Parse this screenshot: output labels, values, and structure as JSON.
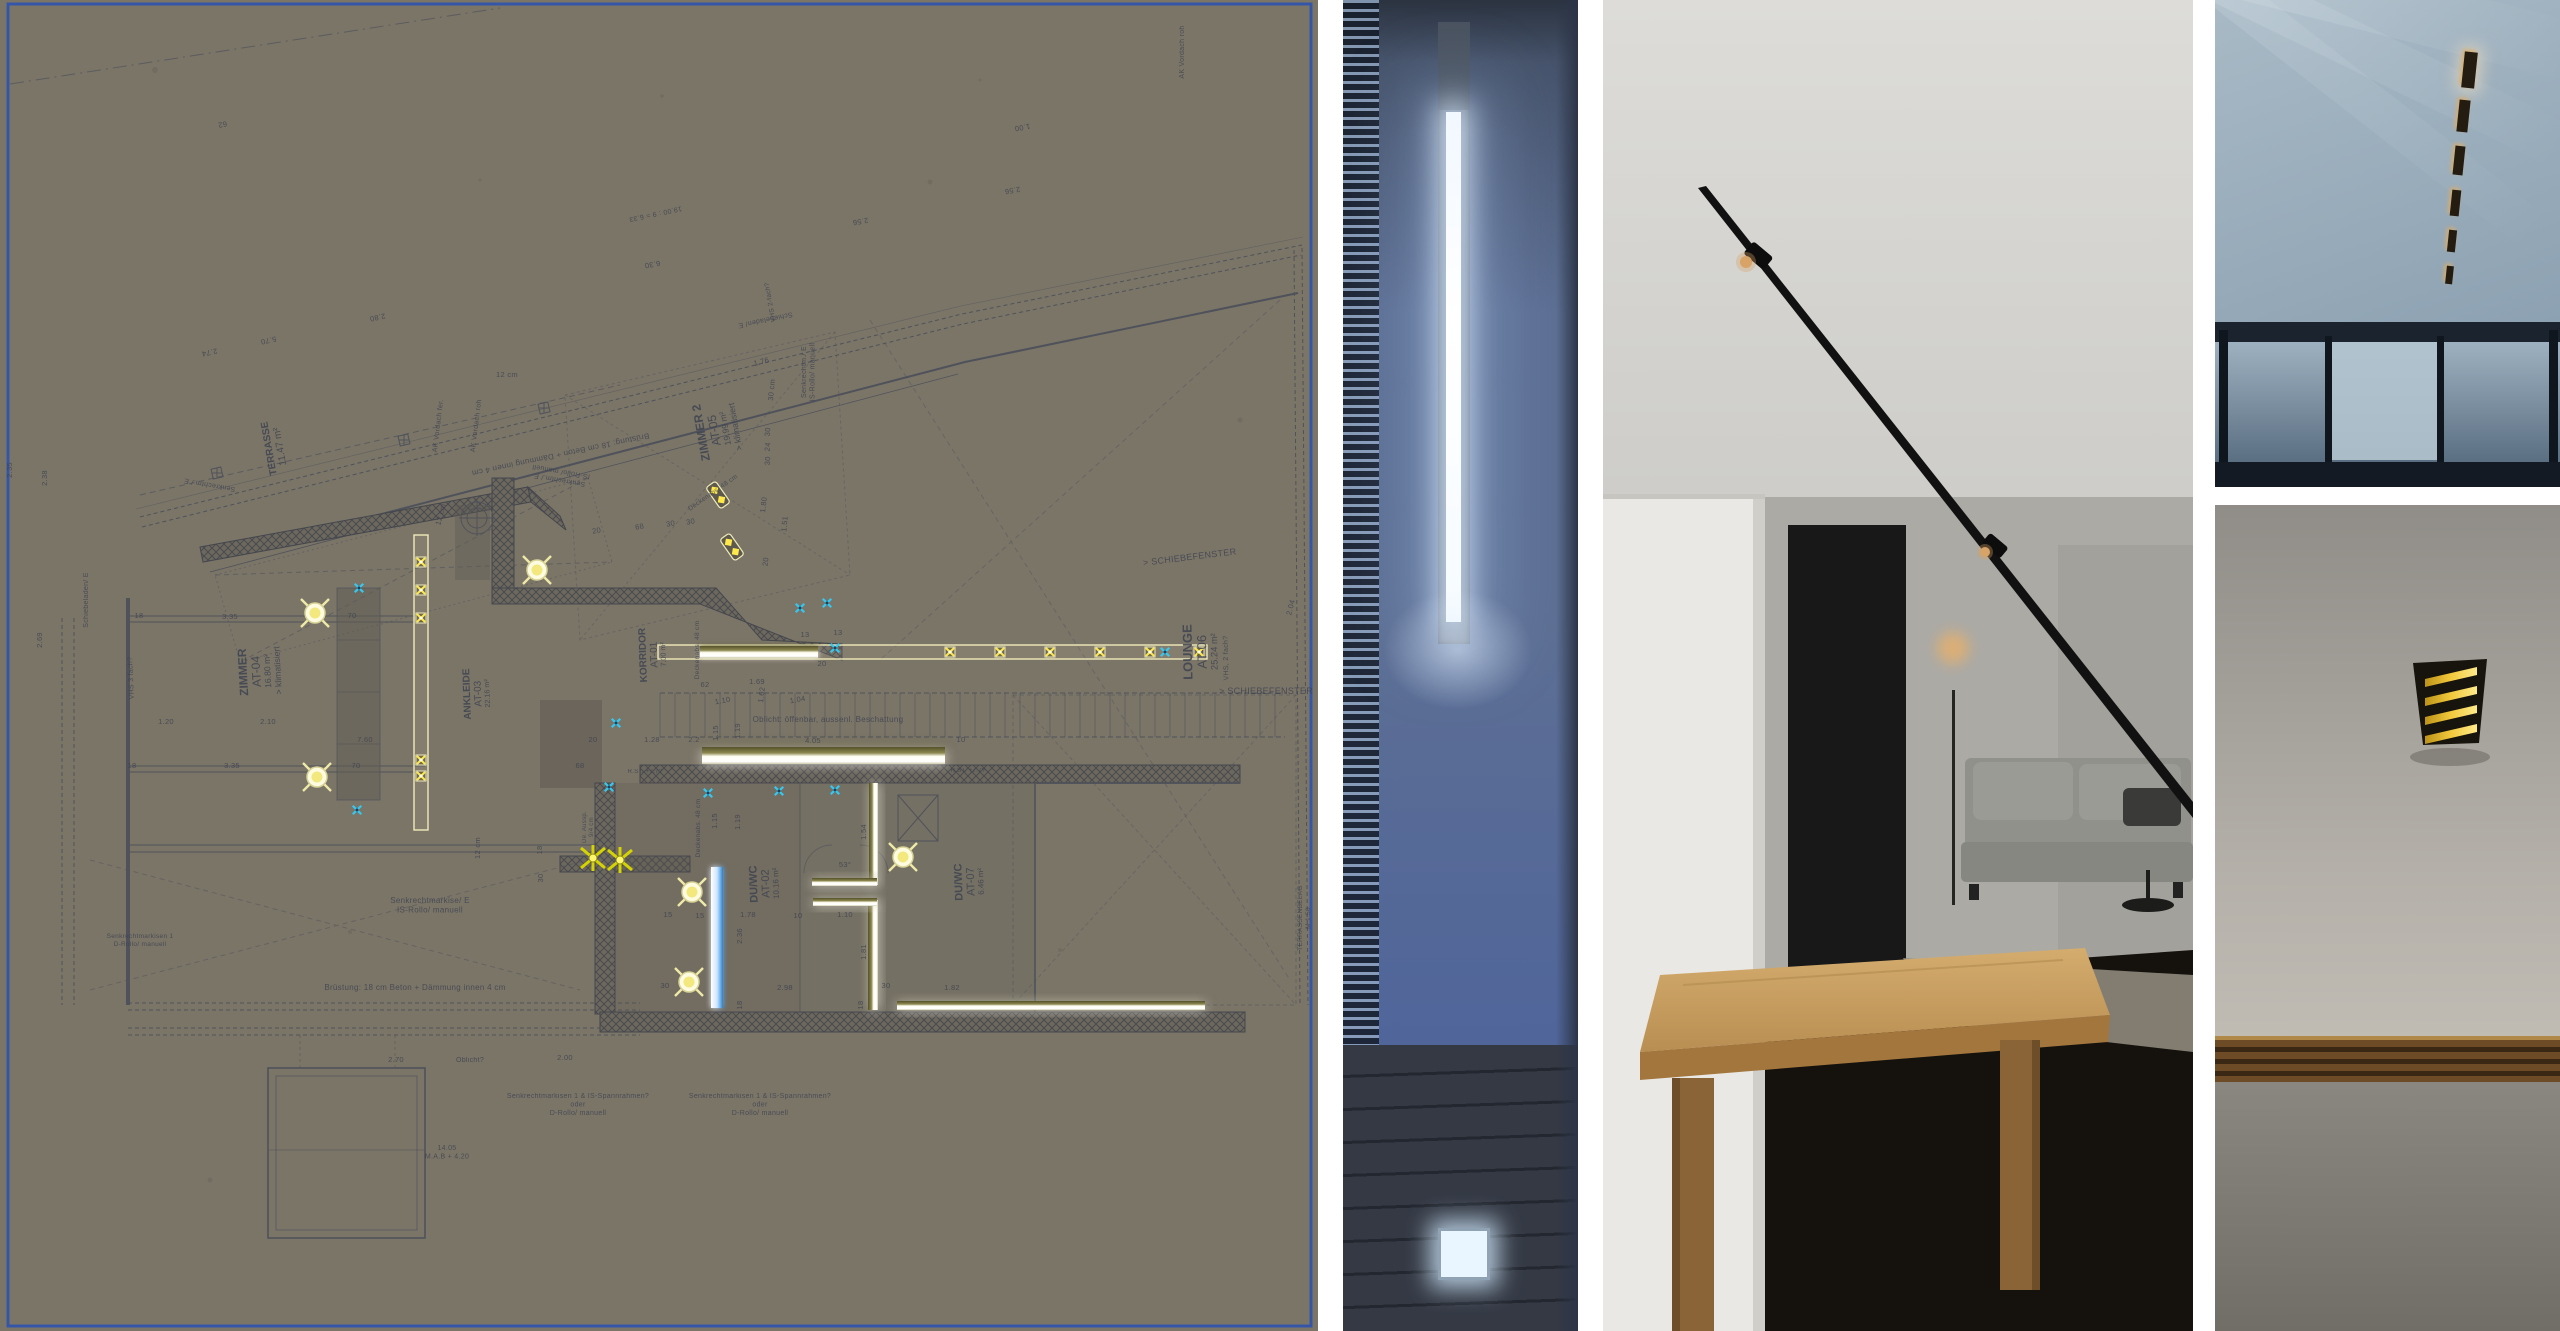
{
  "collage": {
    "panels": [
      {
        "id": "plan-panel",
        "kind": "architectural floor plan on cardboard"
      },
      {
        "id": "photo-slot",
        "kind": "photo: recessed vertical slot luminaire in blue wall"
      },
      {
        "id": "photo-interior",
        "kind": "photo: interior with black ceiling track spots, couch and wood table"
      },
      {
        "id": "photo-ceiling",
        "kind": "photo: ceiling with recessed linear dash lights above glass wall"
      },
      {
        "id": "photo-walllamp",
        "kind": "photo: black wall lamp with yellow louvers on grey wall"
      }
    ]
  },
  "plan": {
    "paper_color": "#7b7568",
    "border_color": "#3556a8",
    "ink": "#3e4350",
    "wall_fill": "#6e6960",
    "light_outline": "#efeab8",
    "lamp_yellow": "#ffe94a",
    "sun_fill": "#fdfbe0",
    "spark_cyan": "#35c8f0",
    "rooms": [
      {
        "name": "TERRASSE",
        "area": "11.47 m²",
        "x": 272,
        "y": 448,
        "rot": -100,
        "size": 10
      },
      {
        "name": "ZIMMER",
        "code": "AT-04",
        "area": "16.80 m²",
        "extra": "> klimatisiert",
        "x": 247,
        "y": 672,
        "rot": -93,
        "size": 12
      },
      {
        "name": "ZIMMER 2",
        "code": "AT-05",
        "area": "19.99 m²",
        "extra": "> klimatisiert",
        "x": 705,
        "y": 432,
        "rot": -100,
        "size": 12
      },
      {
        "name": "ANKLEIDE",
        "code": "AT-03",
        "area": "22.16 m²",
        "x": 470,
        "y": 694,
        "rot": -92,
        "size": 10
      },
      {
        "name": "KORRIDOR",
        "code": "AT-01",
        "area": "7.00 m²",
        "x": 646,
        "y": 655,
        "rot": -92,
        "size": 10
      },
      {
        "name": "LOUNGE",
        "code": "AT-06",
        "area": "25.24 m²",
        "x": 1192,
        "y": 652,
        "rot": -91,
        "size": 13
      },
      {
        "name": "DU/WC",
        "code": "AT-02",
        "area": "10.16 m²",
        "x": 757,
        "y": 884,
        "rot": -92,
        "size": 11
      },
      {
        "name": "DU/WC",
        "code": "AT-07",
        "area": "6.46 m²",
        "x": 962,
        "y": 882,
        "rot": -92,
        "size": 11
      }
    ],
    "notes": [
      {
        "t": "Brüstung: 18 cm Beton + Dämmung innen 4 cm",
        "x": 560,
        "y": 452,
        "rot": 168,
        "size": 8
      },
      {
        "t": "Brüstung: 18 cm Beton + Dämmung innen 4 cm",
        "x": 415,
        "y": 990,
        "rot": 0,
        "size": 8
      },
      {
        "t": "Senkrechtmarkise/ E\nIS-Rollo/ manuell",
        "x": 430,
        "y": 903,
        "rot": 0,
        "size": 8
      },
      {
        "t": "Senkrechtm./ E\nIS-Rollo/ manuell",
        "x": 560,
        "y": 478,
        "rot": 190,
        "size": 7
      },
      {
        "t": "Senkrechtm./ E",
        "x": 210,
        "y": 483,
        "rot": 190,
        "size": 7
      },
      {
        "t": "Senkrechtm./ E\nIS-Rollo/ manuell",
        "x": 806,
        "y": 372,
        "rot": -90,
        "size": 7
      },
      {
        "t": "Schiebeladen/ E",
        "x": 88,
        "y": 600,
        "rot": -90,
        "size": 7
      },
      {
        "t": "Schiebeladen/ E",
        "x": 765,
        "y": 318,
        "rot": 168,
        "size": 7
      },
      {
        "t": "AK Vordach fer.",
        "x": 440,
        "y": 426,
        "rot": -83,
        "size": 7
      },
      {
        "t": "AK Vordach roh",
        "x": 478,
        "y": 426,
        "rot": -83,
        "size": 7
      },
      {
        "t": "AK Vordach roh",
        "x": 1184,
        "y": 52,
        "rot": -90,
        "size": 7
      },
      {
        "t": "Oblicht: öffenbar, aussenl. Beschattung",
        "x": 828,
        "y": 722,
        "rot": 0,
        "size": 8
      },
      {
        "t": "Oblicht?",
        "x": 470,
        "y": 1062,
        "rot": 0,
        "size": 7
      },
      {
        "t": "Deckenabs. 48 cm",
        "x": 699,
        "y": 650,
        "rot": -90,
        "size": 6.5
      },
      {
        "t": "Deckenabs. 48 cm",
        "x": 700,
        "y": 828,
        "rot": -90,
        "size": 6.5
      },
      {
        "t": "Deckenabs. 48 cm",
        "x": 714,
        "y": 494,
        "rot": -35,
        "size": 6.5
      },
      {
        "t": "VHS 3 fach?",
        "x": 133,
        "y": 678,
        "rot": -92,
        "size": 7
      },
      {
        "t": "VHS, 2 fach?",
        "x": 1228,
        "y": 658,
        "rot": -91,
        "size": 7
      },
      {
        "t": "VHS 2-fach?",
        "x": 772,
        "y": 302,
        "rot": -100,
        "size": 6.5
      },
      {
        "t": "> SCHIEBEFENSTER",
        "x": 1190,
        "y": 560,
        "rot": -7,
        "size": 9
      },
      {
        "t": "> SCHIEBEFENSTER",
        "x": 1266,
        "y": 694,
        "rot": 0,
        "size": 9
      },
      {
        "t": "Senkrechtmarkisen 1 & IS-Spannrahmen?\noder\nD-Rollo/ manuell",
        "x": 578,
        "y": 1098,
        "rot": 0,
        "size": 7
      },
      {
        "t": "Senkrechtmarkisen 1 & IS-Spannrahmen?\noder\nD-Rollo/ manuell",
        "x": 760,
        "y": 1098,
        "rot": 0,
        "size": 7
      },
      {
        "t": "Senkrechtmarkisen 1\nD-Rollo/ manuell",
        "x": 140,
        "y": 938,
        "rot": 0,
        "size": 6.5
      },
      {
        "t": "TERRASSENBELAG\nM 1:50",
        "x": 1302,
        "y": 918,
        "rot": -90,
        "size": 6.5
      },
      {
        "t": "R.ST. +7.7?",
        "x": 645,
        "y": 773,
        "rot": 0,
        "size": 6
      },
      {
        "t": "R.ST. +7.7?",
        "x": 968,
        "y": 772,
        "rot": 0,
        "size": 6
      },
      {
        "t": "De. Aussp.\n9/4 cm",
        "x": 586,
        "y": 827,
        "rot": -90,
        "size": 6
      },
      {
        "t": "14.05\nM.A.B + 4.20",
        "x": 447,
        "y": 1150,
        "rot": 0,
        "size": 7
      },
      {
        "t": "19.00 : 9 = 6.33",
        "x": 655,
        "y": 212,
        "rot": 168,
        "size": 7
      }
    ],
    "dims": [
      [
        "18",
        139,
        618,
        0
      ],
      [
        "3.35",
        230,
        619,
        0
      ],
      [
        "70",
        352,
        618,
        0
      ],
      [
        "1.20",
        166,
        724,
        0
      ],
      [
        "2.10",
        268,
        724,
        0
      ],
      [
        "7.60",
        365,
        742,
        0
      ],
      [
        "18",
        132,
        768,
        0
      ],
      [
        "3.35",
        232,
        768,
        0
      ],
      [
        "70",
        356,
        768,
        0
      ],
      [
        "2.38",
        47,
        478,
        -90
      ],
      [
        "2.35",
        12,
        470,
        -90
      ],
      [
        "2.69",
        42,
        640,
        -90
      ],
      [
        "2.74",
        209,
        350,
        168
      ],
      [
        "2.80",
        377,
        315,
        168
      ],
      [
        "5.70",
        268,
        338,
        168
      ],
      [
        "62",
        222,
        122,
        168
      ],
      [
        "2.56",
        860,
        219,
        170
      ],
      [
        "2.56",
        1012,
        188,
        170
      ],
      [
        "1.00",
        1022,
        125,
        170
      ],
      [
        "6.30",
        652,
        262,
        170
      ],
      [
        "1.76",
        762,
        364,
        -15
      ],
      [
        "30 cm",
        774,
        390,
        -85
      ],
      [
        "30",
        770,
        432,
        -85
      ],
      [
        "24",
        770,
        447,
        -85
      ],
      [
        "30",
        770,
        461,
        -85
      ],
      [
        "1.51",
        787,
        524,
        -85
      ],
      [
        "12 cm",
        507,
        377,
        0
      ],
      [
        "12 cm",
        443,
        515,
        -75
      ],
      [
        "20",
        597,
        533,
        -10
      ],
      [
        "68",
        640,
        529,
        -10
      ],
      [
        "30",
        671,
        526,
        -10
      ],
      [
        "30",
        691,
        524,
        -10
      ],
      [
        "1.80",
        766,
        505,
        -83
      ],
      [
        "20",
        768,
        562,
        -83
      ],
      [
        "62",
        705,
        687,
        0
      ],
      [
        "1.69",
        757,
        684,
        0
      ],
      [
        "1.62",
        764,
        695,
        -83
      ],
      [
        "1.10",
        723,
        703,
        -10
      ],
      [
        "1.04",
        798,
        702,
        -10
      ],
      [
        "20",
        593,
        742,
        0
      ],
      [
        "1.28",
        652,
        742,
        0
      ],
      [
        "2.2",
        694,
        742,
        0
      ],
      [
        "4.05",
        813,
        743,
        0
      ],
      [
        "10",
        961,
        742,
        0
      ],
      [
        "1.15",
        718,
        733,
        -90
      ],
      [
        "1.19",
        740,
        731,
        -90
      ],
      [
        "68",
        580,
        768,
        0
      ],
      [
        "1.15",
        717,
        821,
        -90
      ],
      [
        "1.19",
        740,
        822,
        -90
      ],
      [
        "1.54",
        866,
        832,
        -90
      ],
      [
        "53°",
        845,
        867,
        0
      ],
      [
        "15",
        668,
        917,
        0
      ],
      [
        "15",
        700,
        918,
        0
      ],
      [
        "1.78",
        748,
        917,
        0
      ],
      [
        "10",
        798,
        918,
        0
      ],
      [
        "1.10",
        845,
        917,
        0
      ],
      [
        "2.36",
        742,
        936,
        -90
      ],
      [
        "2.98",
        785,
        990,
        0
      ],
      [
        "30",
        665,
        988,
        0
      ],
      [
        "30",
        886,
        988,
        0
      ],
      [
        "1.82",
        952,
        990,
        0
      ],
      [
        "18",
        742,
        1005,
        -90
      ],
      [
        "18",
        863,
        1005,
        -90
      ],
      [
        "1.81",
        866,
        952,
        -90
      ],
      [
        "12 cm",
        480,
        848,
        -90
      ],
      [
        "18",
        542,
        850,
        -90
      ],
      [
        "30",
        543,
        878,
        -90
      ],
      [
        "2.70",
        396,
        1062,
        0
      ],
      [
        "2.00",
        565,
        1060,
        0
      ],
      [
        "2.04",
        1293,
        608,
        -75
      ],
      [
        "13",
        805,
        637,
        0
      ],
      [
        "13",
        838,
        635,
        0
      ],
      [
        "20",
        822,
        666,
        0
      ]
    ],
    "lights": {
      "suns": [
        [
          315,
          613
        ],
        [
          317,
          777
        ],
        [
          537,
          570
        ],
        [
          692,
          892
        ],
        [
          689,
          982
        ],
        [
          903,
          857
        ]
      ],
      "strip_v": {
        "x": 414,
        "y": 535,
        "w": 14,
        "h": 295
      },
      "lamps_v": [
        [
          421,
          562
        ],
        [
          421,
          590
        ],
        [
          421,
          618
        ],
        [
          421,
          760
        ],
        [
          421,
          776
        ]
      ],
      "strip_h": {
        "x": 658,
        "y": 645,
        "w": 549,
        "h": 14
      },
      "white_seg": {
        "x": 700,
        "y": 646,
        "w": 118,
        "h": 12
      },
      "lamps_h": [
        [
          950,
          652
        ],
        [
          1000,
          652
        ],
        [
          1050,
          652
        ],
        [
          1100,
          652
        ],
        [
          1150,
          652
        ],
        [
          1199,
          652
        ]
      ],
      "glow_bars": [
        {
          "x": 702,
          "y": 747,
          "w": 243,
          "h": 17,
          "dir": "v"
        },
        {
          "x": 869,
          "y": 783,
          "w": 9,
          "h": 102,
          "dir": "h"
        },
        {
          "x": 868,
          "y": 900,
          "w": 10,
          "h": 110,
          "dir": "h"
        },
        {
          "x": 812,
          "y": 878,
          "w": 65,
          "h": 8,
          "dir": "v"
        },
        {
          "x": 813,
          "y": 898,
          "w": 64,
          "h": 8,
          "dir": "v"
        },
        {
          "x": 897,
          "y": 1001,
          "w": 308,
          "h": 9,
          "dir": "v"
        }
      ],
      "blue_bar": {
        "x": 711,
        "y": 867,
        "w": 12,
        "h": 141
      },
      "stars": [
        [
          593,
          858
        ],
        [
          620,
          860
        ]
      ],
      "sparkles": [
        [
          359,
          588
        ],
        [
          357,
          810
        ],
        [
          616,
          723
        ],
        [
          609,
          787
        ],
        [
          708,
          793
        ],
        [
          779,
          791
        ],
        [
          835,
          790
        ],
        [
          800,
          608
        ],
        [
          827,
          603
        ],
        [
          835,
          648
        ],
        [
          1165,
          652
        ]
      ],
      "downlights": [
        [
          718,
          495,
          -35
        ],
        [
          732,
          547,
          -35
        ]
      ]
    }
  },
  "photos": {
    "photo2": {
      "wall_top": "#2b3340",
      "wall": "#5d6f94",
      "wall_low": "#50659a",
      "blind_dark": "#151c29",
      "blind_slat": "#8fa4bf",
      "slot_core": "#ffffff",
      "slot_recess": "#626c7c",
      "slot_channel": "#49525f",
      "floor": "#343944",
      "floor_dark": "#23272f",
      "floor_light": "#eaf6ff",
      "shade_right": "#2c3547"
    },
    "photo3": {
      "ceiling": "#d8d7d3",
      "ceiling_dark": "#c2c1bd",
      "white_wall": "#e9e8e4",
      "back_wall": "#abaaa5",
      "right_wall": "#a2a19c",
      "doorway": "#181818",
      "track": "#111111",
      "spot_glow": "#d8a368",
      "table_top": "#c9a165",
      "table_edge": "#a3763e",
      "table_leg": "#8a6336",
      "couch": "#90918b",
      "cushion": "#9a9b94",
      "seat": "#868781",
      "floor": "#15120e",
      "rug": "#8e887c",
      "warm_glow": "#e8b06a"
    },
    "photo4": {
      "ceiling_a": "#a9bac6",
      "ceiling_b": "#8ba0b1",
      "ray": "#d6e1e8",
      "dash": "#241c10",
      "dash_glow": "#d8ad6e",
      "frame": "#1b232e",
      "glass_a": "#9db1c0",
      "glass_b": "#5a6e82",
      "pane_light": "#b3c4cf",
      "sill": "#131a24",
      "dashes": [
        [
          248,
          52,
          13,
          36
        ],
        [
          243,
          100,
          11,
          32
        ],
        [
          239,
          146,
          10,
          29
        ],
        [
          236,
          190,
          9,
          26
        ],
        [
          233,
          230,
          8,
          22
        ],
        [
          231,
          266,
          7,
          18
        ]
      ]
    },
    "photo5": {
      "wall_top": "#908d88",
      "wall_mid": "#b5b1aa",
      "lamp_body": "#17130d",
      "louver": "#f2c93c",
      "louver_dark": "#bd9318",
      "beam_gold": "#b08948",
      "beam_a": "#6d4b27",
      "beam_b": "#3a2815",
      "wall_low_a": "#8a8680",
      "wall_low_b": "#716d67",
      "louver_count": 4
    }
  }
}
